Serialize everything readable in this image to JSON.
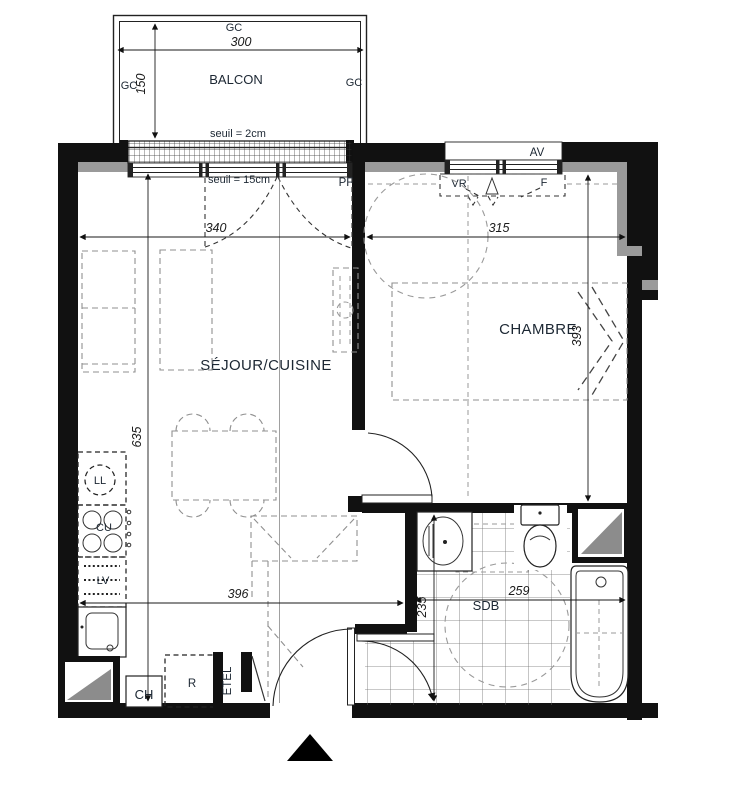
{
  "plan": {
    "balcony": {
      "label": "BALCON",
      "gc_top": "GC",
      "gc_left": "GC",
      "gc_right": "GC",
      "dim_width": "300",
      "dim_depth": "150",
      "threshold": "seuil = 2cm"
    },
    "living": {
      "label": "SÉJOUR/CUISINE",
      "threshold": "seuil = 15cm",
      "window_tag": "PF",
      "dim_top": "340",
      "dim_height": "635",
      "dim_bottom": "396",
      "washer": "LL",
      "cooktop": "CU",
      "dishwasher": "LV",
      "heater": "CH",
      "storage": "R",
      "utility": "ETEL"
    },
    "bedroom": {
      "label": "CHAMBRE",
      "awning_tag": "AV",
      "shutter_tag": "VR",
      "window_tag": "F",
      "dim_top": "315",
      "dim_height": "393"
    },
    "bathroom": {
      "label": "SDB",
      "dim_width": "259",
      "dim_height": "235"
    }
  }
}
